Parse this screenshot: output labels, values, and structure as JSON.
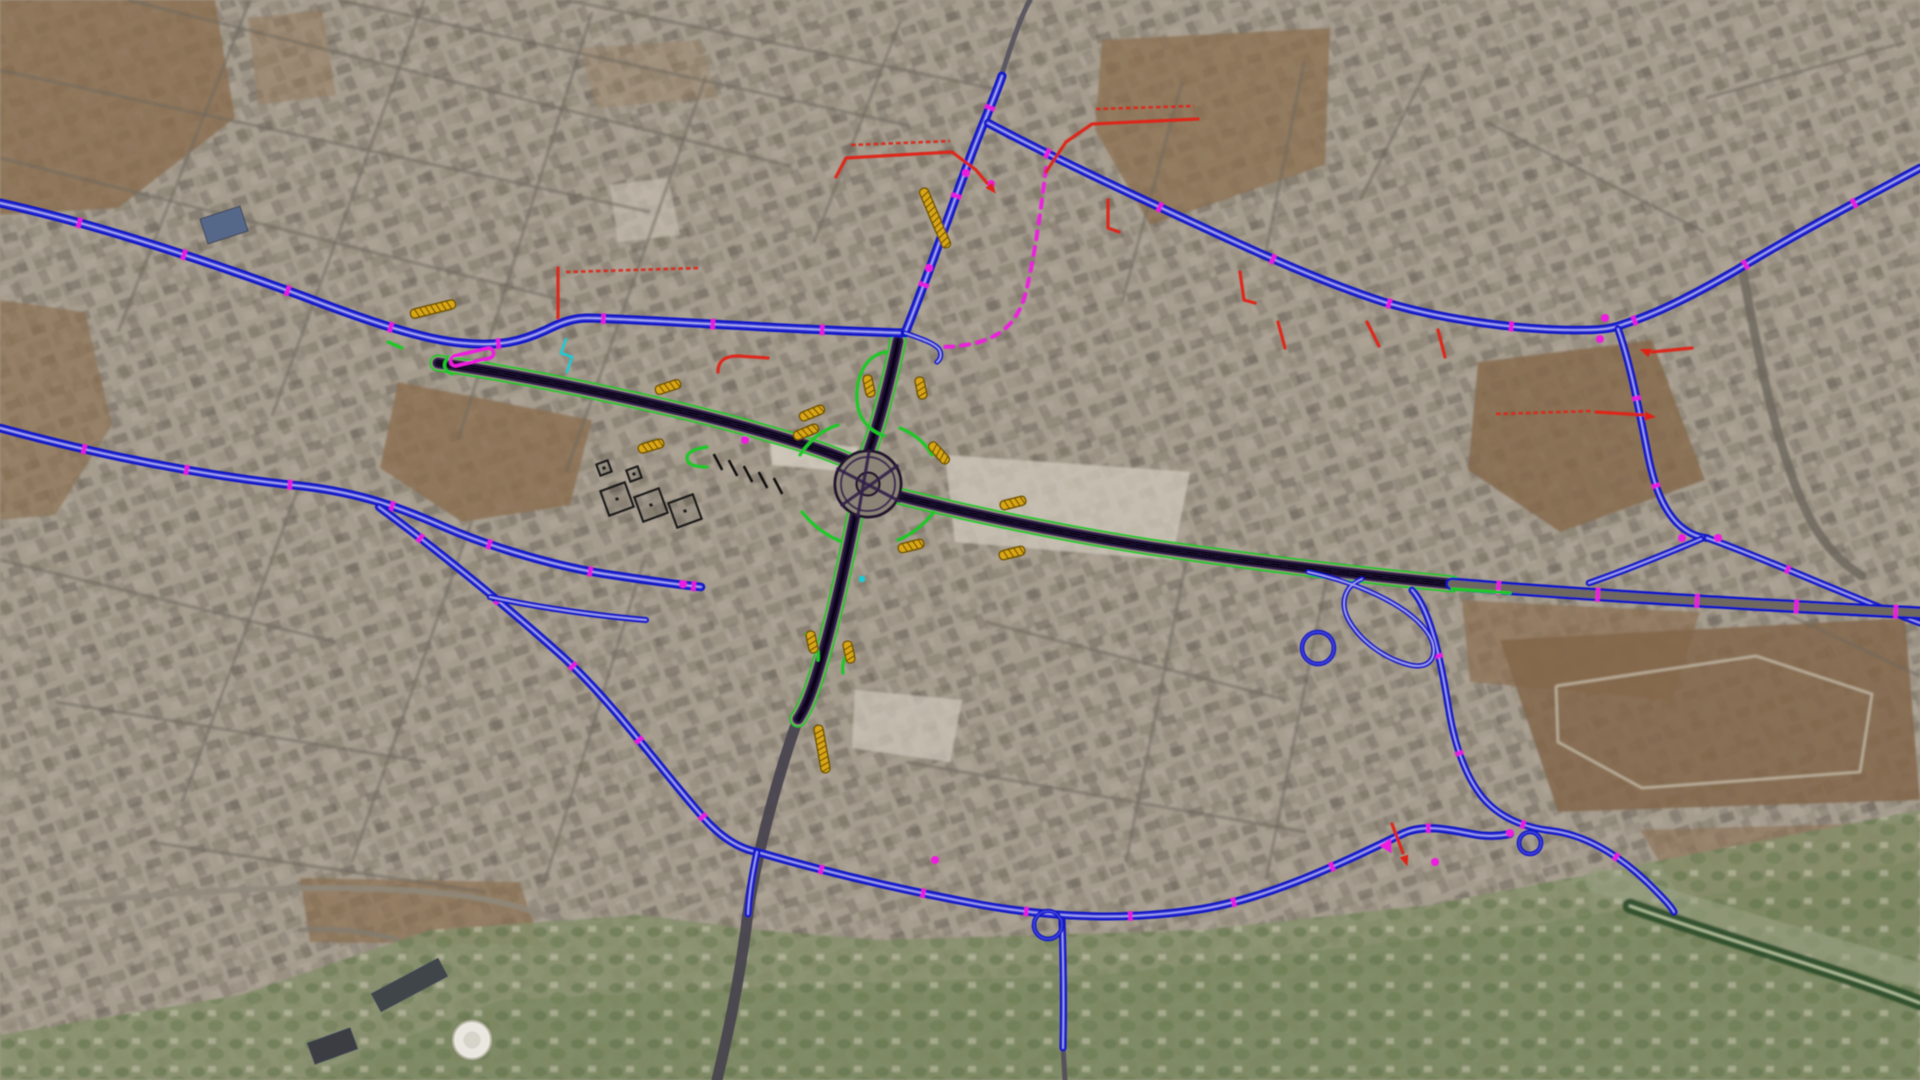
{
  "canvas": {
    "w": 1920,
    "h": 1080,
    "base": "#a59c8e"
  },
  "palette": {
    "blue": "#1113c8",
    "blue_mid": "#3d3fd8",
    "blue_core": "#aeaef2",
    "green": "#1dc926",
    "purple": "#33214b",
    "purple_dark": "#190d2c",
    "lane": "#0a0517",
    "edge_gap": "#978e80",
    "magenta": "#ee1cdf",
    "red": "#e02318",
    "orange": "#d9a614",
    "orange_dark": "#6b4f00",
    "cyan": "#19cdd8",
    "street": "#6e675e"
  },
  "terrain": {
    "fields": [
      {
        "pts": "0,0 215,0 235,118 118,208 0,215",
        "fill": "#8a6d4e",
        "o": 0.78
      },
      {
        "pts": "248,18 322,10 336,95 258,105",
        "fill": "#94785a",
        "o": 0.5
      },
      {
        "pts": "0,300 85,312 112,425 55,515 0,520",
        "fill": "#8a6d4e",
        "o": 0.62
      },
      {
        "pts": "398,382 592,420 570,505 462,522 380,468",
        "fill": "#8a6d4e",
        "o": 0.78
      },
      {
        "pts": "1102,40 1330,28 1325,165 1150,225 1095,130",
        "fill": "#8a6d4e",
        "o": 0.72
      },
      {
        "pts": "1478,362 1652,340 1705,480 1560,532 1468,470",
        "fill": "#85684a",
        "o": 0.8
      },
      {
        "pts": "1462,600 1700,612 1672,700 1470,682",
        "fill": "#8a6d4e",
        "o": 0.68
      },
      {
        "pts": "1500,640 1905,618 1920,800 1558,812",
        "fill": "#82664a",
        "o": 0.85
      },
      {
        "pts": "300,878 520,882 540,945 310,942",
        "fill": "#8a6d4e",
        "o": 0.66
      },
      {
        "pts": "1640,830 1920,822 1920,930 1700,928",
        "fill": "#8c7054",
        "o": 0.6
      },
      {
        "pts": "580,48 700,40 718,98 596,108",
        "fill": "#977c5e",
        "o": 0.4
      }
    ],
    "lots": [
      {
        "pts": "945,455 1190,472 1172,560 955,542",
        "fill": "#cfc8bb",
        "o": 0.75
      },
      {
        "pts": "770,440 858,447 854,472 772,465",
        "fill": "#d6cfc2",
        "o": 0.8
      },
      {
        "pts": "855,690 962,700 950,762 852,748",
        "fill": "#cfc8bb",
        "o": 0.7
      },
      {
        "pts": "610,185 668,178 680,235 618,242",
        "fill": "#c9c2b4",
        "o": 0.6
      }
    ],
    "veg": [
      {
        "pts": "0,1080 0,1035 240,995 430,930 640,915 760,930 880,940 1040,935 1200,930 1430,905 1920,810 1920,1080",
        "fill": "#85906a",
        "o": 0.8
      },
      {
        "pts": "300,1080 500,1000 800,985 1100,975 1500,930 1920,860 1920,1080",
        "fill": "#76855c",
        "o": 0.55
      }
    ],
    "track": {
      "pts": "1556,686 1756,656 1872,694 1860,772 1642,788 1558,742 1556,686",
      "stroke": "#c9c0ae"
    },
    "bands": [
      {
        "d": "M 1598,880 C 1700,912 1830,950 1920,976",
        "w": 26,
        "c": "#9aa285",
        "o": 0.55
      },
      {
        "d": "M 1630,906 C 1720,938 1840,972 1920,1003",
        "w": 15,
        "c": "#2f4f2c",
        "o": 0.95
      },
      {
        "d": "M 1630,906 C 1720,938 1840,972 1920,1003",
        "w": 2.5,
        "c": "#c9d4ae",
        "o": 0.9
      }
    ],
    "streets": [
      {
        "p": "0,70 650,212"
      },
      {
        "p": "0,158 570,302"
      },
      {
        "p": "128,0 790,166"
      },
      {
        "p": "338,0 910,126"
      },
      {
        "p": "566,0 1000,90"
      },
      {
        "p": "250,0 118,332"
      },
      {
        "p": "424,0 272,416"
      },
      {
        "p": "592,12 458,440"
      },
      {
        "p": "706,76 566,472"
      },
      {
        "p": "0,560 336,642"
      },
      {
        "p": "56,702 426,762"
      },
      {
        "p": "150,842 486,892"
      },
      {
        "p": "302,478 182,802"
      },
      {
        "p": "472,520 352,862"
      },
      {
        "p": "644,560 544,884"
      },
      {
        "p": "900,22 814,242"
      },
      {
        "p": "1182,82 1122,302"
      },
      {
        "p": "1304,62 1264,262"
      },
      {
        "p": "1706,98 1906,42"
      },
      {
        "p": "1756,600 1920,676"
      },
      {
        "p": "1486,122 1704,232"
      },
      {
        "p": "986,622 1286,700"
      },
      {
        "p": "906,762 1306,832"
      },
      {
        "p": "1186,562 1126,862"
      },
      {
        "p": "1326,582 1266,880"
      },
      {
        "p": "1430,64 1360,200"
      }
    ],
    "roads_light": [
      {
        "d": "M 60,905 C 200,888 330,884 430,892 C 505,898 560,918 605,938",
        "w": 6,
        "c": "#8f887b",
        "o": 0.85
      },
      {
        "d": "M 300,930 C 380,925 450,950 470,990 C 485,1025 450,1050 400,1050",
        "w": 5,
        "c": "#827c70",
        "o": 0.8
      },
      {
        "d": "M 1742,268 C 1756,342 1772,432 1802,502 C 1817,537 1838,561 1862,576",
        "w": 9,
        "c": "#6b655c",
        "o": 0.8
      }
    ]
  },
  "roads": {
    "gray": [
      {
        "d": "M 798,719 C 781,766 757,850 748,913 C 739,986 726,1042 717,1080",
        "w": 11,
        "c": "#4a4550"
      },
      {
        "d": "M 1002,74 C 1012,42 1022,14 1030,0",
        "w": 5,
        "c": "#5a5560"
      },
      {
        "d": "M 1063,1046 L 1065,1080",
        "w": 5,
        "c": "#55505a"
      }
    ],
    "corridors": [
      {
        "d": "M 438,363 C 520,375 600,392 661,406 C 740,424 815,446 849,461"
      },
      {
        "d": "M 887,493 C 960,512 1060,533 1150,547 C 1260,563 1340,573 1452,584"
      },
      {
        "d": "M 898,341 C 891,375 880,420 869,450"
      },
      {
        "d": "M 855,516 C 846,560 833,622 817,674 C 810,697 803,712 798,719"
      }
    ],
    "blue": [
      {
        "d": "M 0,203 C 100,225 210,262 305,297 C 370,322 425,340 462,343 C 500,347 522,341 546,330 C 562,322 574,318 588,318 C 660,320 790,330 905,333",
        "w": 9,
        "gap": 105,
        "off": 30
      },
      {
        "d": "M 905,333 C 922,292 948,218 970,158 C 981,128 996,94 1002,76",
        "w": 9,
        "gap": 90,
        "off": 45
      },
      {
        "d": "M 988,123 C 1020,140 1080,170 1140,198 C 1230,240 1312,279 1384,302 C 1444,320 1524,331 1584,330 C 1604,330 1614,328 1624,324 C 1662,312 1700,291 1735,271 C 1792,236 1862,199 1920,168",
        "w": 8.5,
        "gap": 120,
        "off": 60
      },
      {
        "d": "M 1618,329 C 1630,362 1639,410 1647,450 C 1653,482 1661,506 1677,523 C 1687,533 1697,537 1707,538",
        "w": 7.5,
        "gap": 85,
        "off": 20
      },
      {
        "d": "M 1701,539 C 1668,553 1624,571 1589,583",
        "w": 6.5,
        "gap": 0,
        "off": 0
      },
      {
        "d": "M 1707,538 C 1762,557 1852,598 1920,623",
        "w": 7,
        "gap": 110,
        "off": 30
      },
      {
        "d": "M 0,428 C 92,453 192,474 292,485 C 352,491 392,504 442,526 C 492,548 562,568 612,575 C 652,581 682,585 701,587",
        "w": 8.5,
        "gap": 100,
        "off": 20
      },
      {
        "d": "M 379,507 C 432,546 502,602 562,656 C 612,701 662,771 702,816 C 722,839 741,849 757,852",
        "w": 8,
        "gap": 95,
        "off": 50
      },
      {
        "d": "M 490,597 C 540,608 600,616 646,620",
        "w": 6,
        "gap": 0,
        "off": 0
      },
      {
        "d": "M 757,852 C 822,871 902,890 982,905 C 1062,919 1132,920 1202,909 C 1272,897 1342,863 1402,834 C 1422,824 1447,829 1472,834 C 1487,837 1500,836 1510,834",
        "w": 8,
        "gap": 100,
        "off": 40
      },
      {
        "d": "M 757,852 C 752,875 749,895 748,914",
        "w": 7,
        "gap": 0,
        "off": 0
      },
      {
        "d": "M 1062,920 C 1063,950 1064,1000 1063,1048",
        "w": 7,
        "gap": 0,
        "off": 0
      },
      {
        "d": "M 1412,590 C 1431,611 1441,661 1449,711 C 1455,746 1465,776 1483,798 C 1501,819 1526,828 1553,831 C 1591,836 1626,861 1651,886 C 1663,898 1671,906 1674,912",
        "w": 7,
        "gap": 95,
        "off": 30
      },
      {
        "d": "M 1308,572 C 1368,585 1420,612 1432,641 C 1438,659 1428,669 1410,665 C 1385,659 1360,641 1348,619 C 1340,603 1344,586 1362,579",
        "w": 5,
        "gap": 0,
        "off": 0
      },
      {
        "d": "M 905,333 C 922,339 934,343 939,349 C 942,354 941,359 937,362",
        "w": 5,
        "gap": 0,
        "off": 0
      }
    ],
    "blue_circles": [
      [
        1318,
        648,
        16
      ],
      [
        1048,
        925,
        14
      ],
      [
        1530,
        843,
        11
      ]
    ],
    "highway_east": {
      "d": "M 1452,584 C 1560,593 1720,603 1920,613",
      "w": 13,
      "gap": 95,
      "off": 55
    },
    "green": [
      {
        "d": "M 800,455 Q 815,432 838,425"
      },
      {
        "d": "M 900,428 Q 922,437 932,455"
      },
      {
        "d": "M 934,512 Q 918,532 898,540"
      },
      {
        "d": "M 802,512 Q 818,532 840,541"
      },
      {
        "d": "M 707,447 Q 687,450 687,458 Q 687,467 707,467"
      },
      {
        "d": "M 886,352 C 862,356 856,382 857,400 C 858,418 868,430 884,436"
      },
      {
        "d": "M 806,634 Q 820,644 818,660"
      },
      {
        "d": "M 852,648 Q 841,659 843,673"
      },
      {
        "d": "M 1452,589 C 1480,591 1498,592 1510,593"
      },
      {
        "d": "M 452,356 C 442,360 442,370 452,374"
      },
      {
        "d": "M 388,342 L 402,348"
      }
    ],
    "lanes": [
      {
        "d": "M 838,469 L 899,501"
      },
      {
        "d": "M 842,505 L 897,466"
      },
      {
        "d": "M 869,452 L 858,515"
      }
    ]
  },
  "markers": {
    "orange": [
      [
        433,
        309,
        -14,
        46
      ],
      [
        668,
        387,
        -18,
        26
      ],
      [
        651,
        446,
        -16,
        26
      ],
      [
        812,
        413,
        -22,
        26
      ],
      [
        806,
        432,
        -22,
        26
      ],
      [
        935,
        218,
        67,
        64
      ],
      [
        869,
        386,
        78,
        22
      ],
      [
        921,
        388,
        78,
        22
      ],
      [
        939,
        453,
        48,
        26
      ],
      [
        1013,
        503,
        -14,
        26
      ],
      [
        1012,
        553,
        -14,
        26
      ],
      [
        911,
        546,
        -14,
        26
      ],
      [
        812,
        642,
        78,
        22
      ],
      [
        849,
        652,
        78,
        22
      ],
      [
        822,
        749,
        80,
        48
      ]
    ],
    "magenta_dots": [
      [
        991,
        184
      ],
      [
        966,
        173
      ],
      [
        929,
        268
      ],
      [
        745,
        440
      ],
      [
        1605,
        318
      ],
      [
        1600,
        339
      ],
      [
        1682,
        538
      ],
      [
        1718,
        538
      ],
      [
        1510,
        833
      ],
      [
        1435,
        862
      ],
      [
        935,
        860
      ],
      [
        683,
        584
      ]
    ],
    "magenta_capsule": {
      "x": 472,
      "y": 357,
      "a": -13,
      "len": 44
    },
    "magenta_dash": {
      "d": "M 1046,168 C 1042,200 1036,250 1026,292 C 1018,322 1002,336 976,343 C 962,346 950,347 941,347"
    },
    "magenta_blob": [
      [
        1385,
        842,
        60
      ]
    ],
    "cyan": [
      {
        "d": "M 566,339 L 561,353 L 572,357 L 567,372"
      }
    ],
    "cyan_dots": [
      [
        862,
        579
      ]
    ],
    "red_lines": [
      {
        "d": "M 836,177 L 846,158 L 952,152 L 976,170 L 987,183",
        "arrow": [
          989,
          185,
          52
        ]
      },
      {
        "d": "M 1046,172 L 1066,142 L 1092,124 L 1198,119"
      },
      {
        "d": "M 558,318 L 558,268"
      },
      {
        "d": "M 718,372 C 718,360 726,356 738,356 L 768,358"
      },
      {
        "d": "M 1596,412 L 1643,415",
        "arrow": [
          1645,
          416,
          5
        ]
      },
      {
        "d": "M 1652,352 L 1692,348",
        "arrow": [
          1650,
          353,
          200
        ]
      },
      {
        "d": "M 1108,200 L 1108,228 L 1119,232"
      },
      {
        "d": "M 1240,272 L 1244,300 L 1255,303"
      },
      {
        "d": "M 1278,322 L 1285,348"
      },
      {
        "d": "M 1367,322 L 1379,346"
      },
      {
        "d": "M 1438,330 L 1445,357"
      },
      {
        "d": "M 1392,824 L 1403,853",
        "arrow": [
          1404,
          856,
          72
        ]
      }
    ],
    "red_texts": [
      {
        "d": "M 851,145 L 950,141"
      },
      {
        "d": "M 1096,109 L 1194,106"
      },
      {
        "d": "M 566,272 L 700,268"
      },
      {
        "d": "M 1496,414 L 1592,411"
      }
    ]
  },
  "structures": {
    "black_dashes": [
      [
        718,
        462,
        62,
        18
      ],
      [
        733,
        468,
        62,
        18
      ],
      [
        748,
        474,
        62,
        18
      ],
      [
        763,
        480,
        62,
        18
      ],
      [
        778,
        486,
        62,
        18
      ]
    ],
    "buildings": [
      [
        604,
        486,
        26,
        26,
        -20
      ],
      [
        638,
        492,
        26,
        26,
        -20
      ],
      [
        672,
        498,
        26,
        26,
        -20
      ],
      [
        598,
        462,
        12,
        12,
        -20
      ],
      [
        628,
        468,
        12,
        12,
        -20
      ]
    ],
    "building_fills": [
      {
        "x": 203,
        "y": 212,
        "w": 42,
        "h": 26,
        "a": -18,
        "fill": "#56688a"
      },
      {
        "x": 372,
        "y": 975,
        "w": 75,
        "h": 20,
        "a": -28,
        "fill": "#41454a"
      },
      {
        "x": 310,
        "y": 1035,
        "w": 45,
        "h": 22,
        "a": -20,
        "fill": "#3a3e42"
      }
    ],
    "tank": {
      "cx": 472,
      "cy": 1040,
      "r": 19
    },
    "roundabout": {
      "cx": 868,
      "cy": 484,
      "r": 34
    }
  }
}
